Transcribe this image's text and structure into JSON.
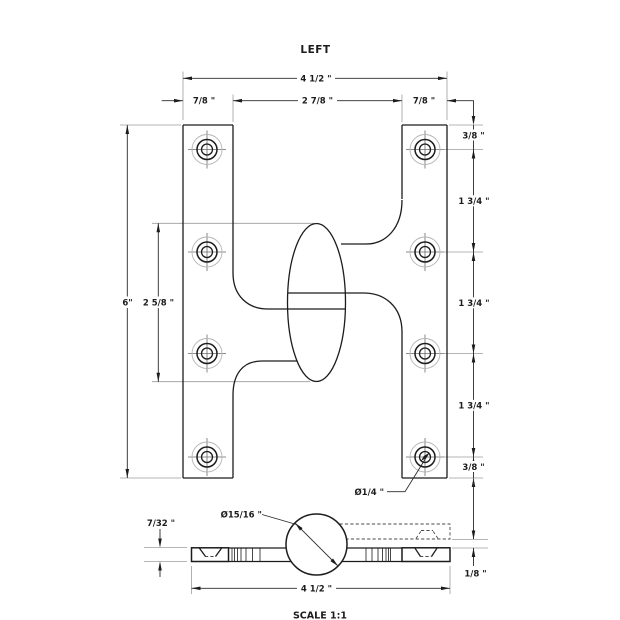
{
  "title": "LEFT",
  "scale_note": "SCALE 1:1",
  "colors": {
    "line": "#1c1c1c",
    "extension": "#9c9c9c",
    "background": "#ffffff"
  },
  "dimensions": {
    "top_width": "4 1/2 \"",
    "top_left_leaf": "7/8 \"",
    "top_center_span": "2 7/8 \"",
    "top_right_leaf": "7/8 \"",
    "right_chain": [
      "3/8 \"",
      "1 3/4 \"",
      "1 3/4 \"",
      "1 3/4 \"",
      "3/8 \""
    ],
    "left_height": "6\"",
    "knuckle_height": "2 5/8 \"",
    "hole_diameter": "Ø1/4 \"",
    "knuckle_diameter": "Ø15/16 \"",
    "left_thickness": "7/32 \"",
    "right_thickness": "1/8 \"",
    "bottom_width": "4 1/2 \""
  }
}
